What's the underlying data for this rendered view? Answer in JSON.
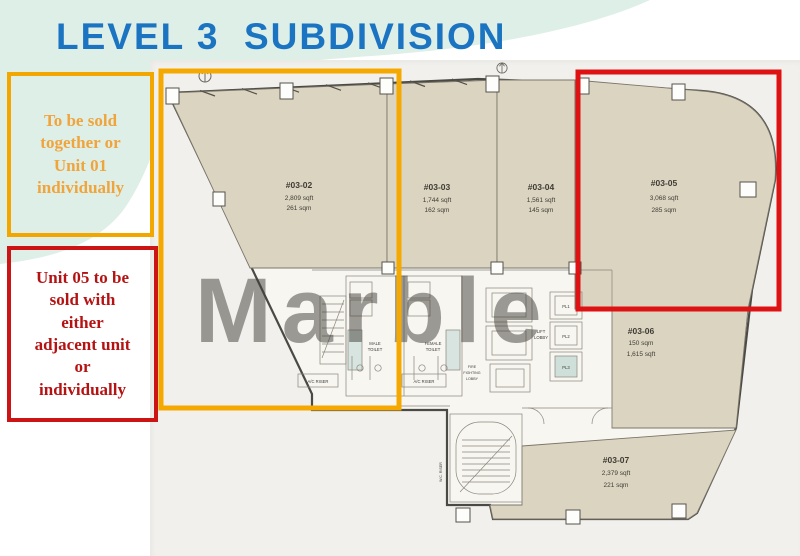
{
  "title": "LEVEL 3  SUBDIVISION",
  "watermark": "Marble",
  "notes": {
    "yellow_text": "To be sold\ntogether or\nUnit 01\nindividually",
    "red_text": "Unit 05 to be\nsold with\neither\nadjacent unit\nor\nindividually"
  },
  "units": [
    {
      "id": "#03-02",
      "sqft": "2,809 sqft",
      "sqm": "261 sqm"
    },
    {
      "id": "#03-03",
      "sqft": "1,744 sqft",
      "sqm": "162 sqm"
    },
    {
      "id": "#03-04",
      "sqft": "1,561 sqft",
      "sqm": "145 sqm"
    },
    {
      "id": "#03-05",
      "sqft": "3,068 sqft",
      "sqm": "285 sqm"
    },
    {
      "id": "#03-06",
      "sqm": "150 sqm",
      "sqft": "1,615 sqft"
    },
    {
      "id": "#03-07",
      "sqft": "2,379 sqft",
      "sqm": "221 sqm"
    }
  ],
  "core": {
    "lifts": [
      "PL1",
      "PL2",
      "PL3"
    ],
    "lift_lobby": [
      "LIFT",
      "LOBBY"
    ],
    "fire_lobby": [
      "FIRE",
      "FIGHTING",
      "LOBBY"
    ],
    "male_toilet": [
      "MALE",
      "TOILET"
    ],
    "female_toilet": [
      "FEMALE",
      "TOILET"
    ],
    "ac_riser": "A/C RISER",
    "wc_riser": "W.C. RISER"
  },
  "colors": {
    "title_blue": "#1B74C1",
    "highlight_yellow": "#F5A800",
    "highlight_red": "#DE1212",
    "note_yellow_text": "#F0A43C",
    "note_red_text": "#B51313",
    "unit_fill": "#DBD4C1",
    "mint_bg": "#DEEFE7"
  }
}
